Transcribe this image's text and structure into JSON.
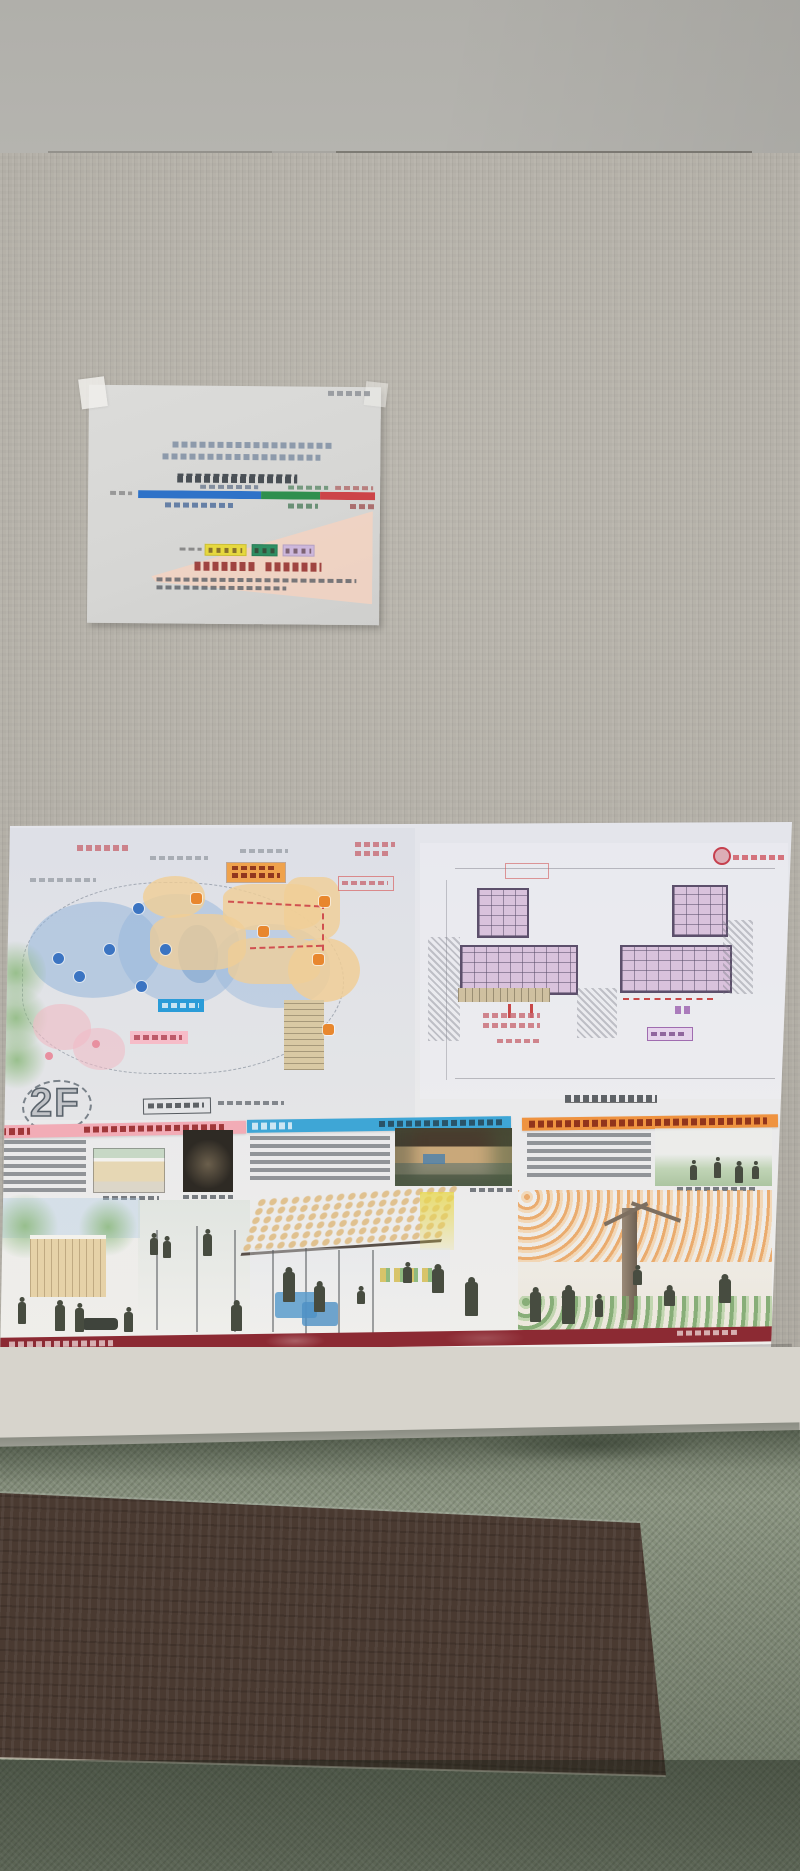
{
  "poster": {
    "floor_label": "2F",
    "panel_headers": [
      {
        "id": "panel-left",
        "color": "#f2acb6"
      },
      {
        "id": "panel-middle",
        "color": "#3ea6d6"
      },
      {
        "id": "panel-right",
        "color": "#ef9340"
      }
    ],
    "footer_color": "#8c2a33",
    "site_plan_zone_colors": {
      "blue": "#aecbe6",
      "orange": "#f2d7ac",
      "green": "#a3cb9b",
      "pink": "#f1c7ce",
      "stairs_tan": "#d9c9a4"
    },
    "site_plan_label_chips": {
      "blue": "#2b9cd8",
      "pink": "#f6bcc8",
      "orange": "#efa24c"
    },
    "floor_plan_room_color": "#d9c2dc",
    "stamp_color": "#c6404e"
  },
  "paper": {
    "bar": {
      "segments": [
        {
          "name": "segment-blue",
          "color": "#2e72c8",
          "pct": 52
        },
        {
          "name": "segment-green",
          "color": "#2e8f4e",
          "pct": 25
        },
        {
          "name": "segment-red",
          "color": "#cc4448",
          "pct": 23
        }
      ]
    },
    "chips": [
      {
        "name": "chip-yellow",
        "color": "#e6d83e"
      },
      {
        "name": "chip-green",
        "color": "#2e8f63"
      },
      {
        "name": "chip-lavender",
        "color": "#cdb7dc"
      }
    ],
    "wedge_color": "#f3d2c1"
  },
  "room": {
    "wall_color": "#b7b3aa",
    "ceiling_color": "#b2b1ac",
    "carpet_color": "#8a9480",
    "wood_color": "#4a3a31",
    "board_color": "#d7d4cc"
  }
}
